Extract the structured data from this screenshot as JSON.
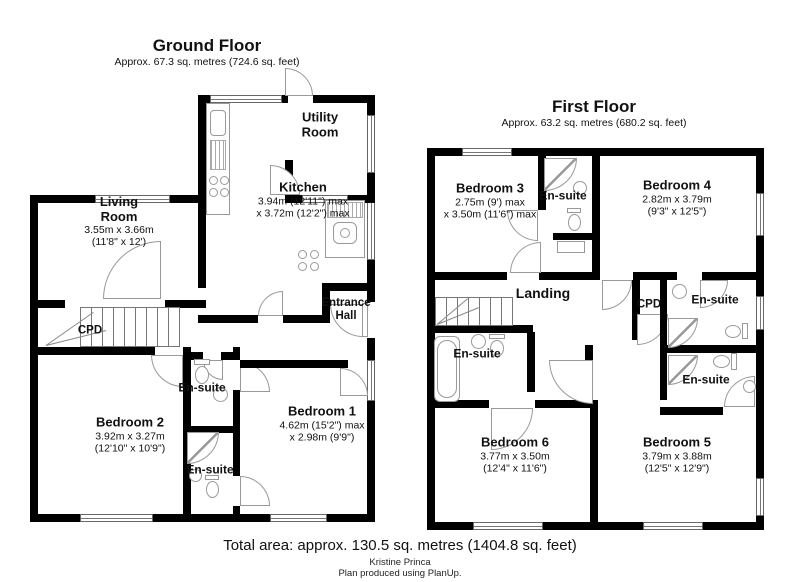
{
  "ground_floor": {
    "title": "Ground Floor",
    "subtitle": "Approx. 67.3 sq. metres (724.6 sq. feet)",
    "rooms": {
      "living_room": {
        "name": "Living Room",
        "dim_metric": "3.55m x 3.66m",
        "dim_imperial": "(11'8\" x 12')"
      },
      "kitchen": {
        "name": "Kitchen",
        "dim_metric": "3.94m (12'11\") max",
        "dim_imperial": "x 3.72m (12'2\") max"
      },
      "utility_room": {
        "name": "Utility Room"
      },
      "entrance_hall": {
        "name": "Entrance Hall"
      },
      "cpd": {
        "name": "CPD"
      },
      "bedroom_2": {
        "name": "Bedroom 2",
        "dim_metric": "3.92m x 3.27m",
        "dim_imperial": "(12'10\" x 10'9\")"
      },
      "bedroom_1": {
        "name": "Bedroom 1",
        "dim_metric": "4.62m (15'2\") max",
        "dim_imperial": "x 2.98m (9'9\")"
      },
      "ensuite_upper": {
        "name": "En-suite"
      },
      "ensuite_lower": {
        "name": "En-suite"
      }
    }
  },
  "first_floor": {
    "title": "First Floor",
    "subtitle": "Approx. 63.2 sq. metres (680.2 sq. feet)",
    "rooms": {
      "bedroom_3": {
        "name": "Bedroom 3",
        "dim_metric": "2.75m (9') max",
        "dim_imperial": "x 3.50m (11'6\") max"
      },
      "bedroom_4": {
        "name": "Bedroom 4",
        "dim_metric": "2.82m x 3.79m",
        "dim_imperial": "(9'3\" x 12'5\")"
      },
      "landing": {
        "name": "Landing"
      },
      "cpd": {
        "name": "CPD"
      },
      "ensuite_top": {
        "name": "En-suite"
      },
      "ensuite_right_upper": {
        "name": "En-suite"
      },
      "ensuite_right_lower": {
        "name": "En-suite"
      },
      "ensuite_left": {
        "name": "En-suite"
      },
      "bedroom_6": {
        "name": "Bedroom 6",
        "dim_metric": "3.77m x 3.50m",
        "dim_imperial": "(12'4\" x 11'6\")"
      },
      "bedroom_5": {
        "name": "Bedroom 5",
        "dim_metric": "3.79m x 3.88m",
        "dim_imperial": "(12'5\" x 12'9\")"
      }
    }
  },
  "footer": {
    "total_area": "Total area: approx. 130.5 sq. metres (1404.8 sq. feet)",
    "author": "Kristine Princa",
    "credit": "Plan produced using PlanUp."
  }
}
